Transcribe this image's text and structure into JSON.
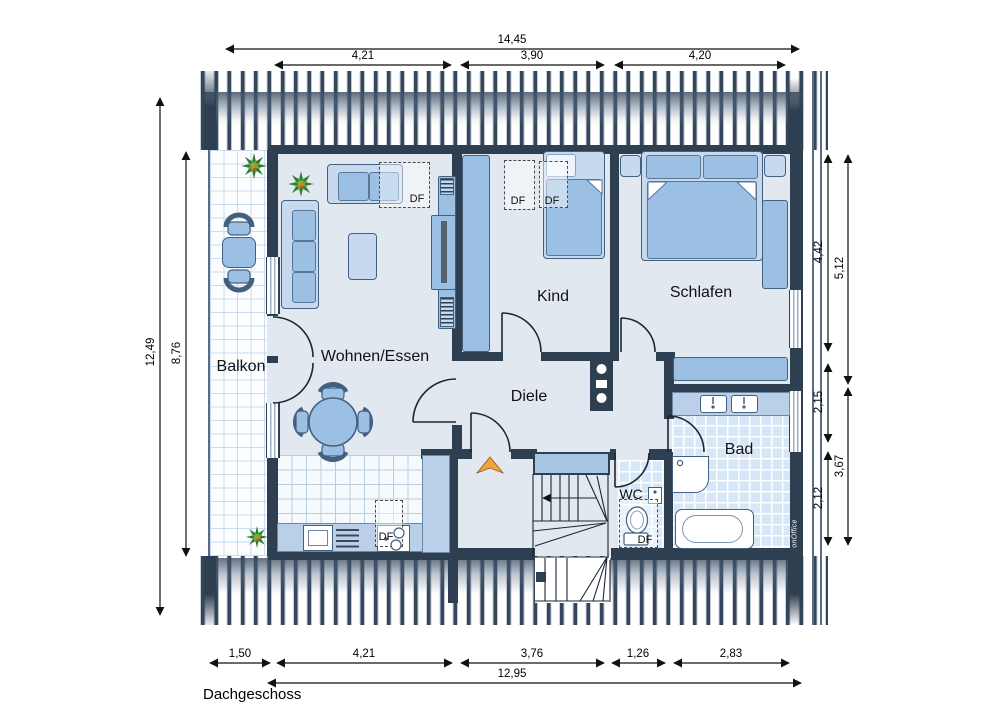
{
  "title": "Dachgeschoss",
  "watermark": "onOffice",
  "rooms": {
    "balcony": "Balkon",
    "living": "Wohnen/Essen",
    "child": "Kind",
    "bedroom": "Schlafen",
    "hall": "Diele",
    "bath": "Bad",
    "wc": "WC"
  },
  "labels": {
    "roof_window": "DF"
  },
  "dimensions": {
    "top_total": "14,45",
    "top": [
      "4,21",
      "3,90",
      "4,20"
    ],
    "left": [
      "12,49",
      "8,76"
    ],
    "right": [
      "4,42",
      "5,12",
      "2,15",
      "3,67",
      "2,12"
    ],
    "bottom": [
      "1,50",
      "4,21",
      "3,76",
      "1,26",
      "2,83"
    ],
    "bottom_total": "12,95"
  },
  "colors": {
    "wall": "#2f3f52",
    "furniture": "#9cbfe4",
    "furniture_light": "#c6d9ee",
    "counter": "#b9d0e8",
    "entry_arrow": "#f2a23e",
    "plant_green": "#3e8f2f"
  }
}
